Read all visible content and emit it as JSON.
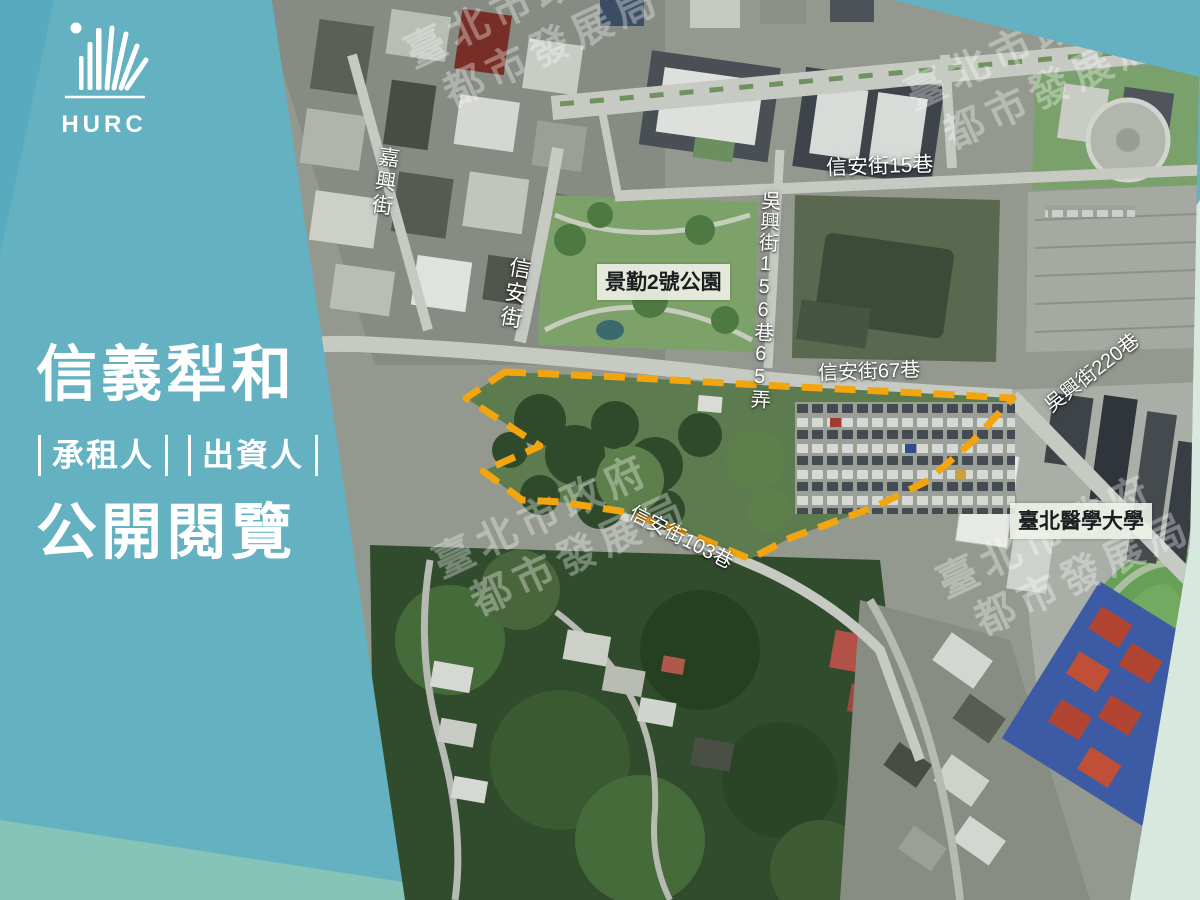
{
  "brand": {
    "logo_text": "HURC"
  },
  "panel": {
    "title_top": "信義犁和",
    "roles": [
      {
        "label": "承租人"
      },
      {
        "label": "出資人"
      }
    ],
    "title_bottom": "公開閱覽"
  },
  "map": {
    "watermark": {
      "line1": "臺北市政府",
      "line2": "都市發展局"
    },
    "labels": {
      "jiaxing_st": "嘉興街",
      "xinan_st": "信安街",
      "xinan_ln15": "信安街15巷",
      "wuxing_ln156_65": "吳興街156巷65弄",
      "park": "景勤2號公園",
      "xinan_ln67": "信安街67巷",
      "wuxing_ln220": "吳興街220巷",
      "xinan_ln103": "信安街103巷",
      "tmu": "臺北醫學大學"
    },
    "site_boundary_color": "#F3A50F"
  },
  "colors": {
    "background_teal": "#63b1c1",
    "band_sage": "#87c4b8",
    "band_mint": "#d7e8df",
    "site_boundary": "#F3A50F",
    "label_text": "#ffffff"
  }
}
